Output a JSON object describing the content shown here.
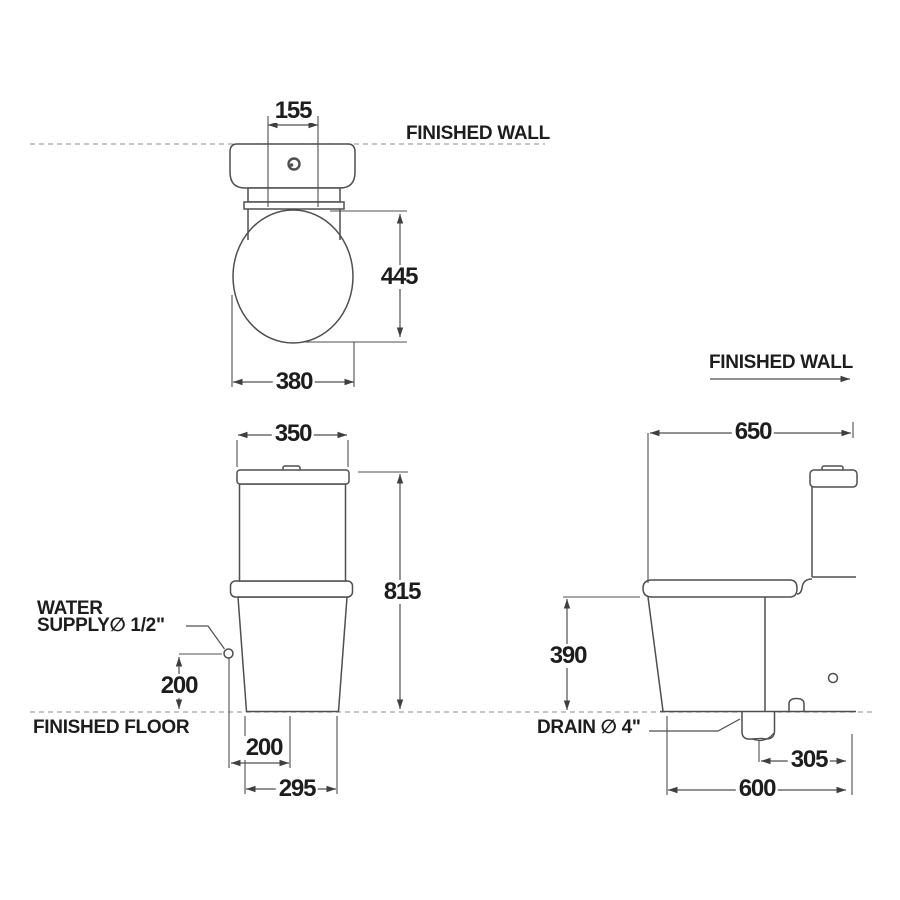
{
  "page": {
    "background": "#ffffff"
  },
  "labels": {
    "finished_wall_top": "FINISHED WALL",
    "finished_wall_side": "FINISHED WALL",
    "finished_floor": "FINISHED FLOOR",
    "water_supply_line1": "WATER",
    "water_supply_line2": "SUPPLY∅ 1/2\"",
    "drain": "DRAIN ∅ 4\""
  },
  "dimensions": {
    "top_view": {
      "inlet_width": "155",
      "bowl_depth": "445",
      "bowl_width": "380"
    },
    "front_view": {
      "tank_width": "350",
      "overall_height": "815",
      "water_supply_height": "200",
      "water_supply_side_offset": "200",
      "base_width": "295"
    },
    "side_view": {
      "overall_depth": "650",
      "bowl_rim_height": "390",
      "drain_to_wall": "305",
      "base_depth": "600"
    }
  },
  "colors": {
    "line": "#4f4f4f",
    "dimension_line": "#4f4f4f",
    "dashed_reference_line": "#a3a3a3",
    "text": "#1d1d1d",
    "background": "#ffffff"
  }
}
